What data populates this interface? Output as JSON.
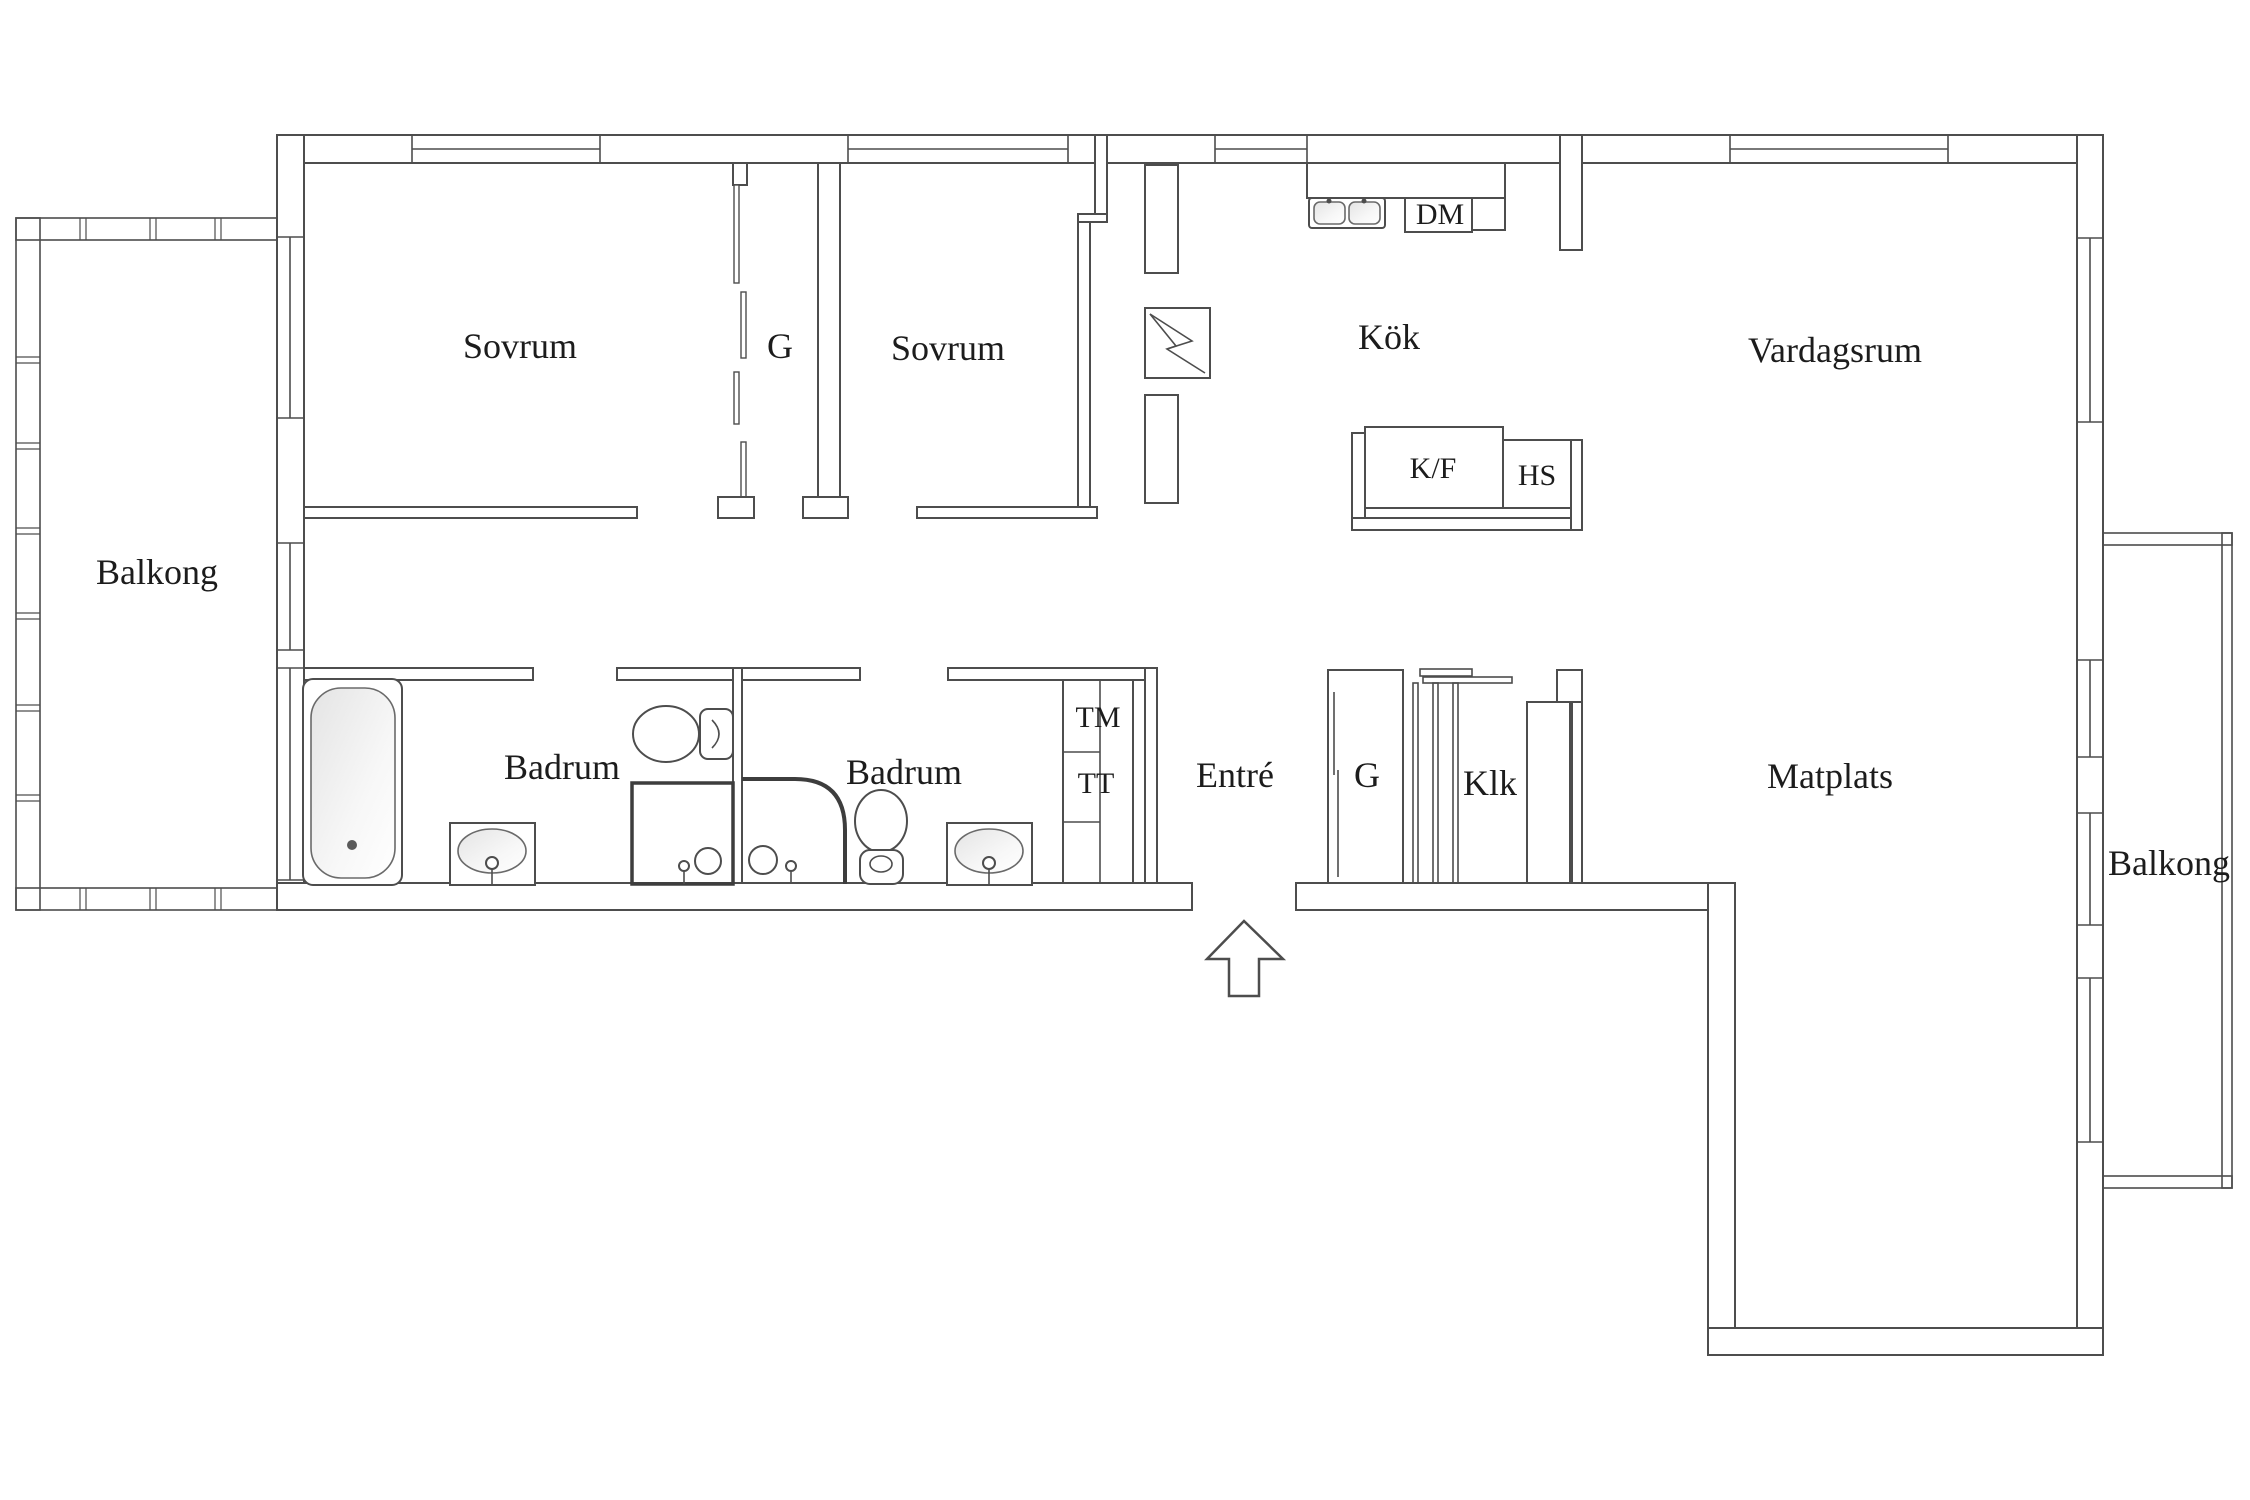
{
  "plan": {
    "type": "apartment-floor-plan",
    "labels": {
      "sovrum_1": "Sovrum",
      "garderob_top": "G",
      "sovrum_2": "Sovrum",
      "kok": "Kök",
      "vardagsrum": "Vardagsrum",
      "balkong_left": "Balkong",
      "badrum_1": "Badrum",
      "badrum_2": "Badrum",
      "entre": "Entré",
      "garderob_entre": "G",
      "klk": "Klk",
      "matplats": "Matplats",
      "balkong_right": "Balkong",
      "dm": "DM",
      "kf": "K/F",
      "hs": "HS",
      "tm": "TM",
      "tt": "TT"
    },
    "colors": {
      "line": "#4d4d4d",
      "text": "#1c1c1c",
      "fixture_shade": "#e8e8e8",
      "background": "#ffffff"
    }
  }
}
